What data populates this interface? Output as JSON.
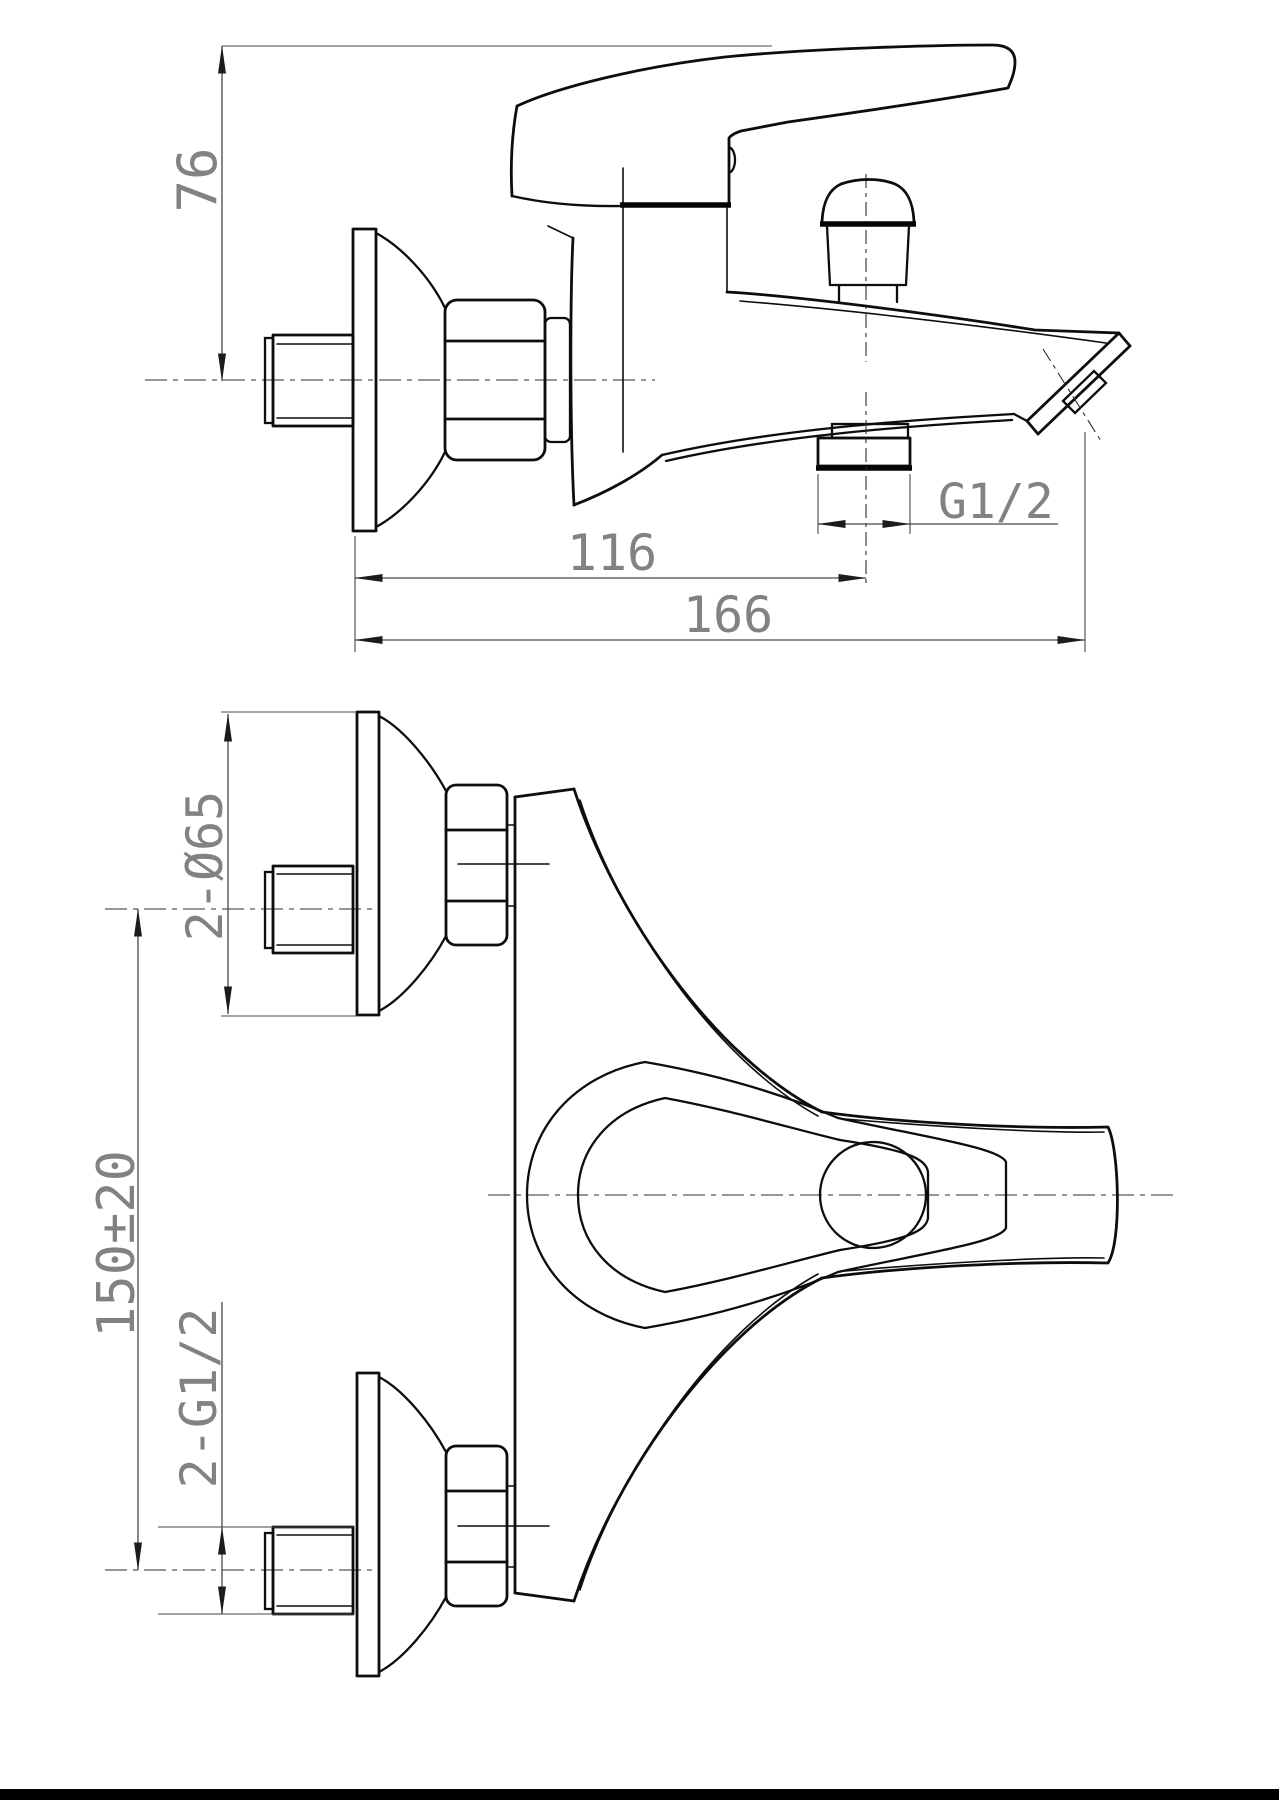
{
  "meta": {
    "document_type": "technical installation drawing",
    "subject": "wall-mounted single-lever bath shower mixer",
    "units": "mm"
  },
  "colors": {
    "background": "#ffffff",
    "line": "#0d0d0d",
    "dimension_line": "#474747",
    "dimension_text": "#828282",
    "footer_bar": "#000000"
  },
  "views": {
    "side": {
      "name": "side elevation (upper view)",
      "dims": {
        "height": "76",
        "wall_to_outlet": "116",
        "wall_to_tip": "166",
        "outlet_thread": "G1/2"
      }
    },
    "plan": {
      "name": "plan view (lower view)",
      "dims": {
        "flange": "2-Ø65",
        "centres": "150±20",
        "thread": "2-G1/2"
      }
    }
  }
}
